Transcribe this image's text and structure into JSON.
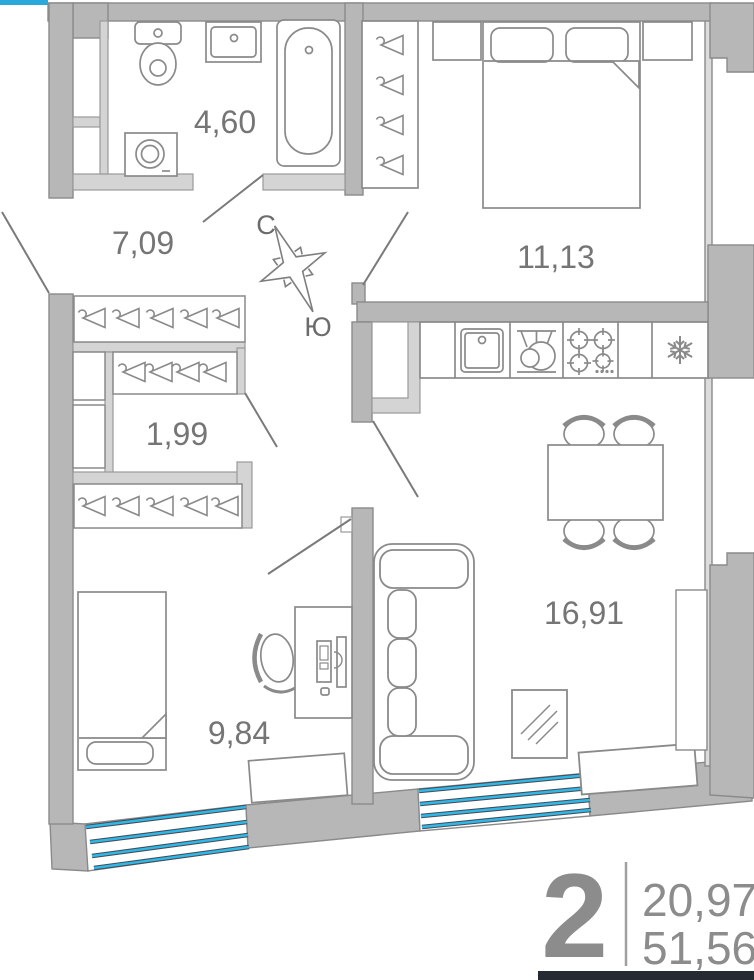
{
  "plan": {
    "rooms": [
      {
        "name": "bathroom",
        "area": "4,60"
      },
      {
        "name": "hallway",
        "area": "7,09"
      },
      {
        "name": "walk-in-closet",
        "area": "1,99"
      },
      {
        "name": "bedroom",
        "area": "11,13"
      },
      {
        "name": "kitchen-living-room",
        "area": "16,91"
      },
      {
        "name": "bedroom-2",
        "area": "9,84"
      }
    ],
    "compass": {
      "north_label": "С",
      "south_label": "Ю"
    },
    "summary": {
      "room_count": "2",
      "living_area": "20,97",
      "total_area": "51,56"
    },
    "icons": {
      "fridge": "snowflake-icon",
      "closet_rails": "hanger-icon",
      "orientation": "compass-rose-icon"
    },
    "colors": {
      "wall": "#b7b7b7",
      "partition": "#d4d4d4",
      "outline": "#8a8a8a",
      "window_glass": "#2fb9e8",
      "window_edge": "#454b57",
      "label_text": "#757575",
      "footer_bar": "#262a33",
      "accent_strip": "#29a8dc"
    }
  }
}
